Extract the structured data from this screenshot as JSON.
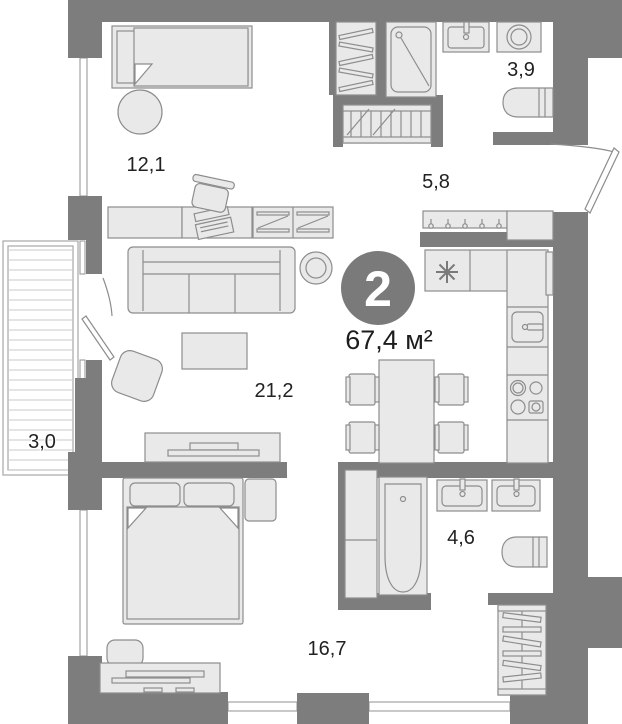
{
  "badge": {
    "room_count": "2",
    "total_area": "67,4 м²"
  },
  "rooms": [
    {
      "id": "bedroom-top",
      "area_label": "12,1"
    },
    {
      "id": "bathroom-top",
      "area_label": "3,9"
    },
    {
      "id": "hallway",
      "area_label": "5,8"
    },
    {
      "id": "living-kitchen",
      "area_label": "21,2"
    },
    {
      "id": "balcony",
      "area_label": "3,0"
    },
    {
      "id": "bathroom-bottom",
      "area_label": "4,6"
    },
    {
      "id": "bedroom-bottom",
      "area_label": "16,7"
    }
  ],
  "colors": {
    "wall": "#7d7d7d",
    "furniture_fill": "#e9e9e9",
    "furniture_stroke": "#8d8d8d",
    "badge": "#7a7a7a",
    "text": "#222222",
    "deck_line": "#c9c9c9",
    "background": "#ffffff"
  }
}
